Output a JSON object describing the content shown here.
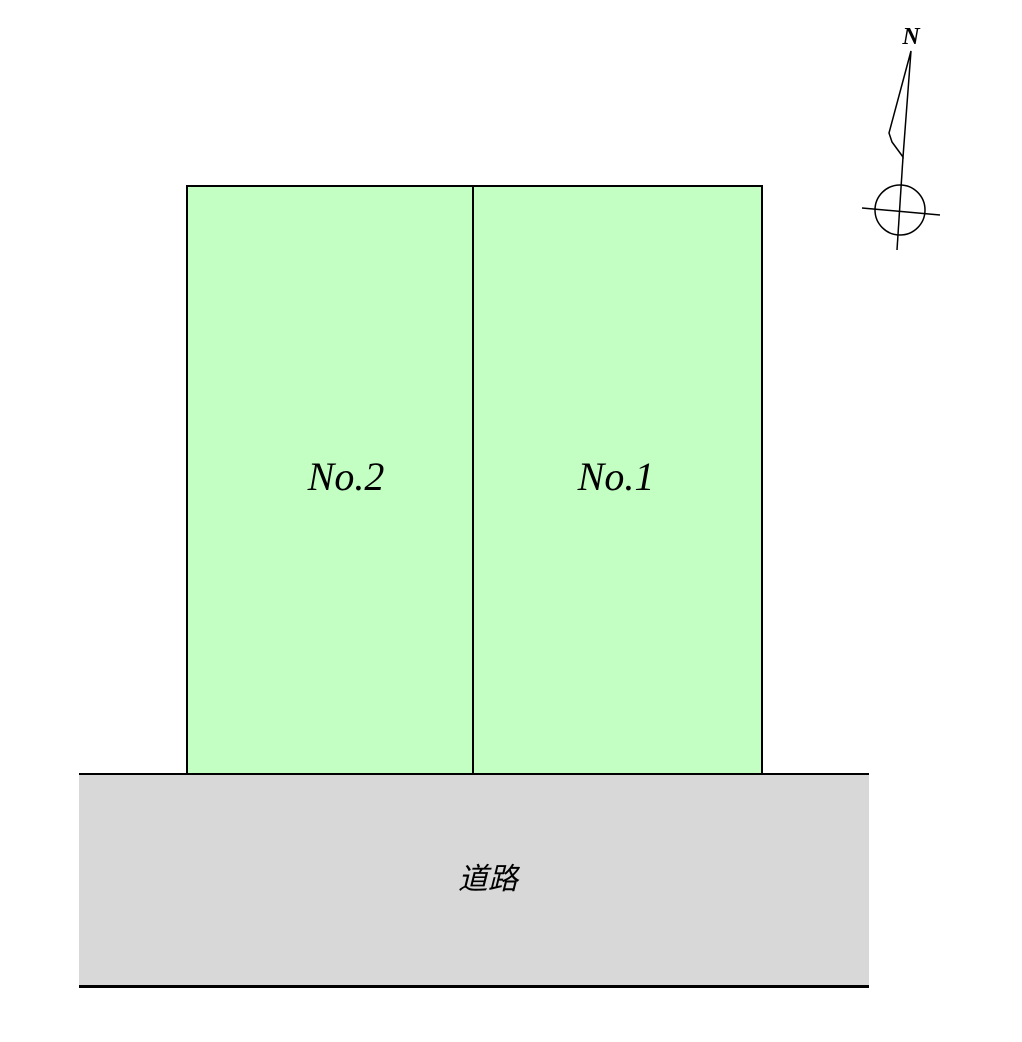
{
  "plots": [
    {
      "id": "no2",
      "label": "No.2"
    },
    {
      "id": "no1",
      "label": "No.1"
    }
  ],
  "road": {
    "label": "道路"
  },
  "compass": {
    "north_label": "N"
  },
  "colors": {
    "background": "#ffffff",
    "plot_fill": "#c3ffc3",
    "road_fill": "#d8d8d8",
    "line": "#000000"
  }
}
